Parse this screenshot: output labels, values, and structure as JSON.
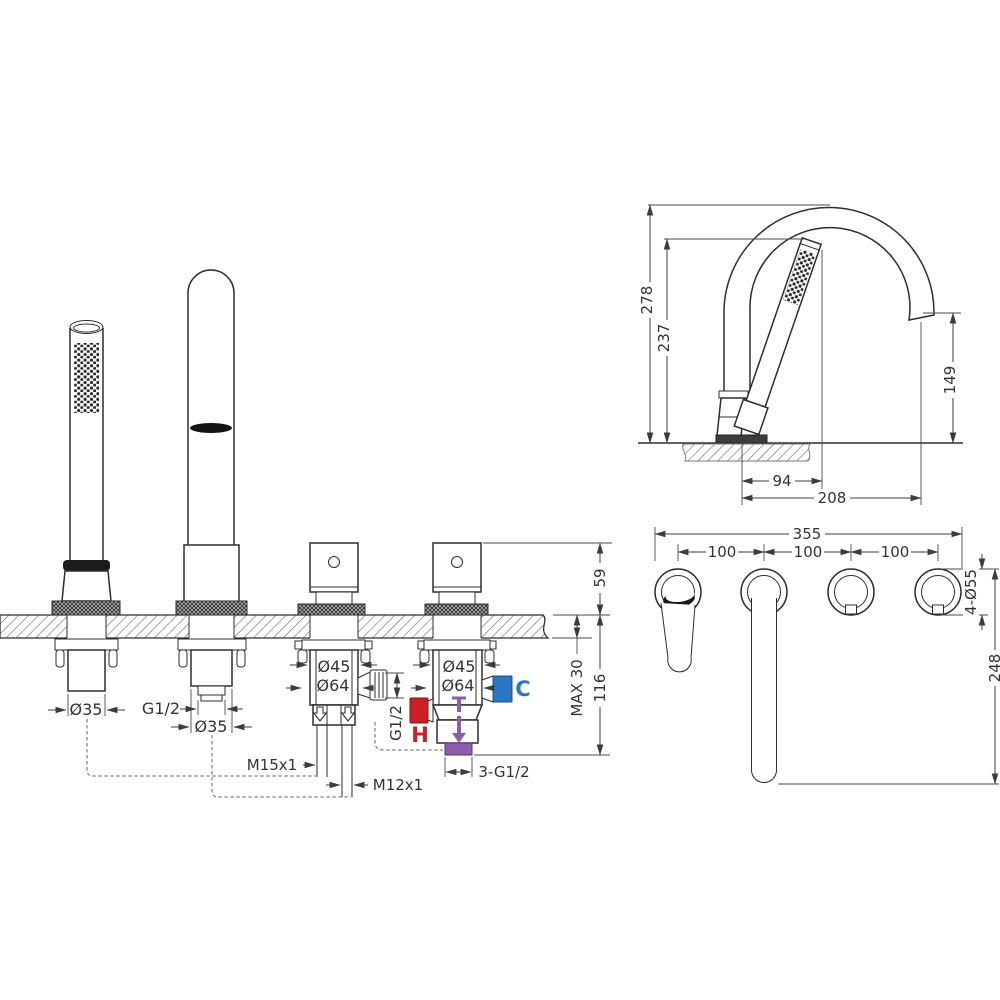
{
  "title": "bath-mixer-installation-drawing",
  "front": {
    "handshower_dia": "Ø35",
    "spout_thread": "G1/2",
    "spout_dia": "Ø35",
    "hose_m15": "M15x1",
    "hose_m12": "M12x1",
    "cartridge_dia": "Ø45",
    "body_dia": "Ø64",
    "port_thread": "G1/2",
    "outlet_thread": "3-G1/2",
    "height_above_deck": "59",
    "deck_thickness_max": "MAX 30",
    "depth_below_deck": "116",
    "hot": "H",
    "cold": "C",
    "mixed": "T"
  },
  "side": {
    "total_height": "278",
    "handshower_height": "237",
    "spout_outlet_height": "149",
    "spout_offset": "94",
    "total_reach": "208"
  },
  "plan": {
    "overall_width": "355",
    "hole_spacing": "100",
    "hole_diameter": "4-Ø55",
    "depth": "248"
  },
  "colors": {
    "hot": "#cc2028",
    "cold": "#2a77c5",
    "mixed": "#8d5da9",
    "line": "#2e2e2e"
  }
}
